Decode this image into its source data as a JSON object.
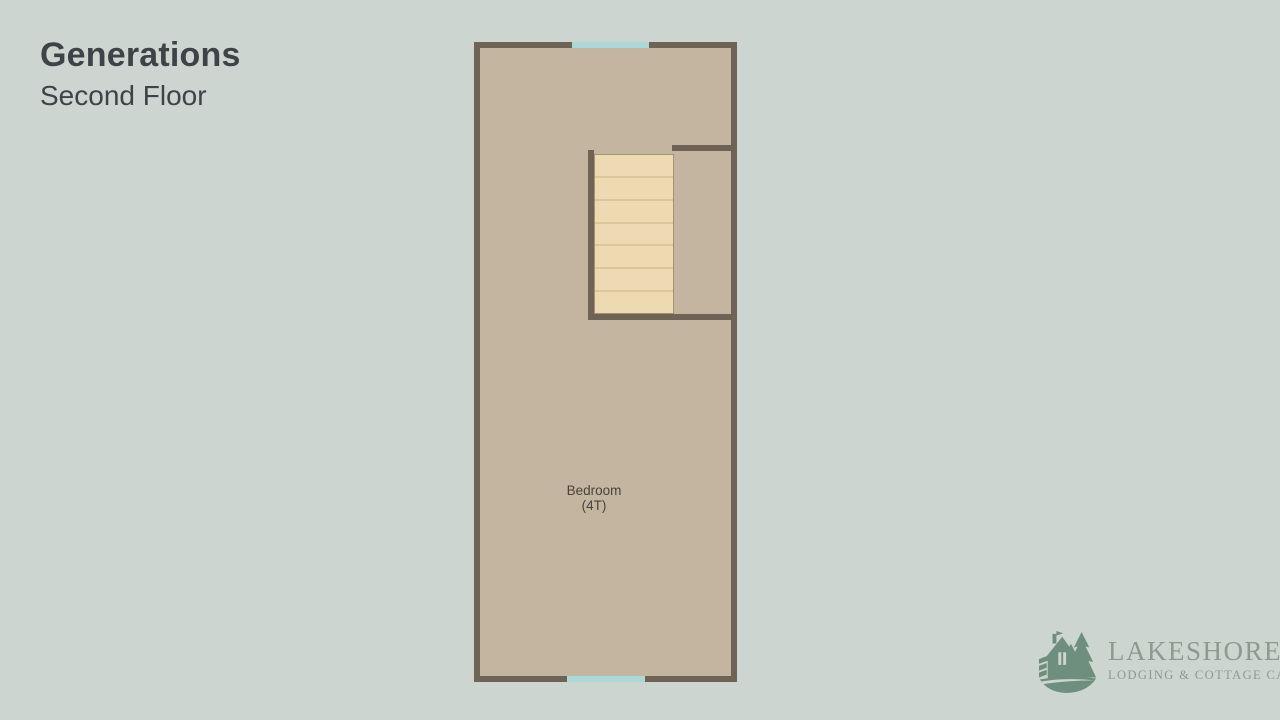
{
  "colors": {
    "background": "#cdd5d1",
    "text": "#3d4347",
    "floor": "#c4b5a0",
    "wall": "#6e6355",
    "stairs": "#eedab2",
    "stair_line": "#d9c69b",
    "stair_border": "#a3946e",
    "window": "#a9d8d6",
    "label": "#48443b",
    "logo_green": "#6f8f7e",
    "logo_text": "#8c9a90"
  },
  "header": {
    "title": "Generations",
    "subtitle": "Second Floor"
  },
  "floorplan": {
    "room": {
      "label": "Bedroom",
      "sublabel": "(4T)"
    },
    "stairs": {
      "steps": 7
    },
    "windows": [
      "top",
      "bottom"
    ]
  },
  "logo": {
    "name": "LAKESHORE",
    "tagline": "LODGING & COTTAGE CARE",
    "icon": "cottage-trees-wave-icon"
  }
}
